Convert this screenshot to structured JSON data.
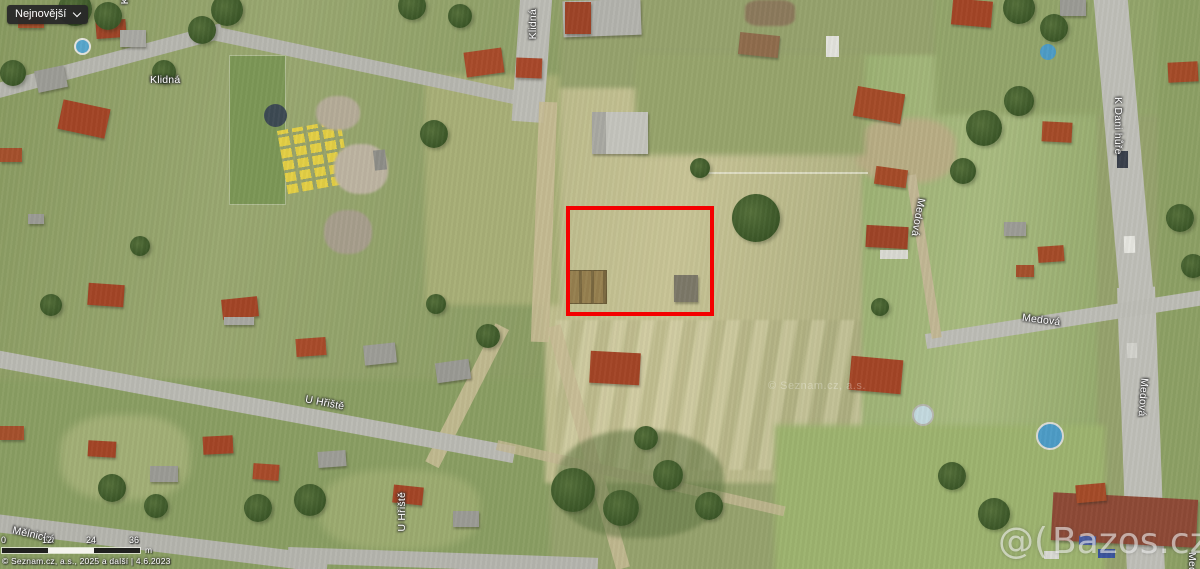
{
  "controls": {
    "sort_dropdown_label": "Nejnovější"
  },
  "map": {
    "street_labels": {
      "klidna_top_clipped": "Klidná",
      "klidna_vertical": "Klidná",
      "klidna_horizontal": "Klidná",
      "k_dani_hure": "K Dani hůře",
      "medova_upper": "Medová",
      "medova_road": "Medová",
      "medova_right": "Medová",
      "medova_bottom_clipped": "Medová",
      "u_hriste_road": "U Hřiště",
      "u_hriste_vertical": "U Hřiště",
      "melnicka": "Mělnická"
    },
    "scale_bar": {
      "tick_0": "0",
      "tick_1": "12",
      "tick_2": "24",
      "tick_3": "36",
      "unit": "m"
    },
    "attribution": "© Seznam.cz, a.s., 2025 a další | 4.6.2023",
    "center_watermark": "© Seznam.cz, a.s.",
    "bazos_mark": "@(",
    "bazos_text": "Bazos.cz",
    "highlight_color": "#f40000"
  }
}
